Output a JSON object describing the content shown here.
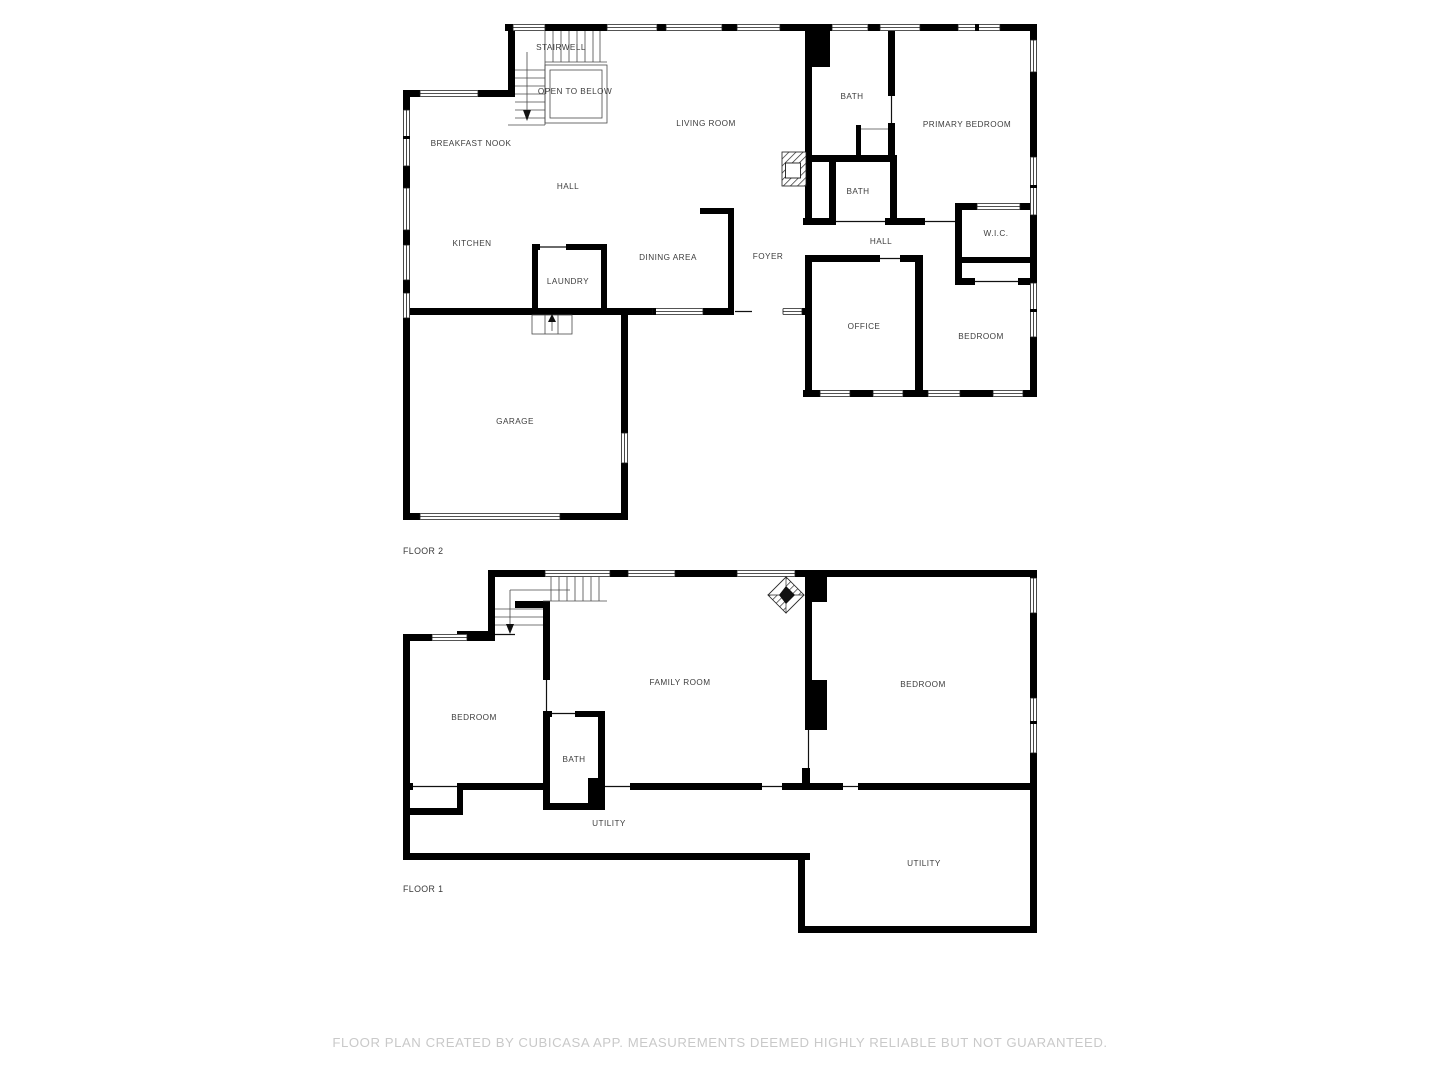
{
  "document": {
    "background": "#ffffff"
  },
  "colors": {
    "wall": "#000000",
    "label": "#3d3d3d",
    "footer_text": "#c9c9c9"
  },
  "floor2": {
    "caption": "FLOOR 2",
    "rooms": {
      "stairwell": "STAIRWELL",
      "open_to_below": "OPEN TO BELOW",
      "living_room": "LIVING ROOM",
      "bath_upper": "BATH",
      "primary_bedroom": "PRIMARY BEDROOM",
      "breakfast_nook": "BREAKFAST NOOK",
      "hall_west": "HALL",
      "bath_lower": "BATH",
      "kitchen": "KITCHEN",
      "dining_area": "DINING AREA",
      "laundry": "LAUNDRY",
      "foyer": "FOYER",
      "hall_east": "HALL",
      "wic": "W.I.C.",
      "office": "OFFICE",
      "bedroom": "BEDROOM",
      "garage": "GARAGE"
    }
  },
  "floor1": {
    "caption": "FLOOR 1",
    "rooms": {
      "bedroom_west": "BEDROOM",
      "family_room": "FAMILY ROOM",
      "bedroom_east": "BEDROOM",
      "bath": "BATH",
      "utility_west": "UTILITY",
      "utility_east": "UTILITY"
    }
  },
  "footer": {
    "disclaimer": "FLOOR PLAN CREATED BY CUBICASA APP. MEASUREMENTS DEEMED HIGHLY RELIABLE BUT NOT GUARANTEED."
  }
}
